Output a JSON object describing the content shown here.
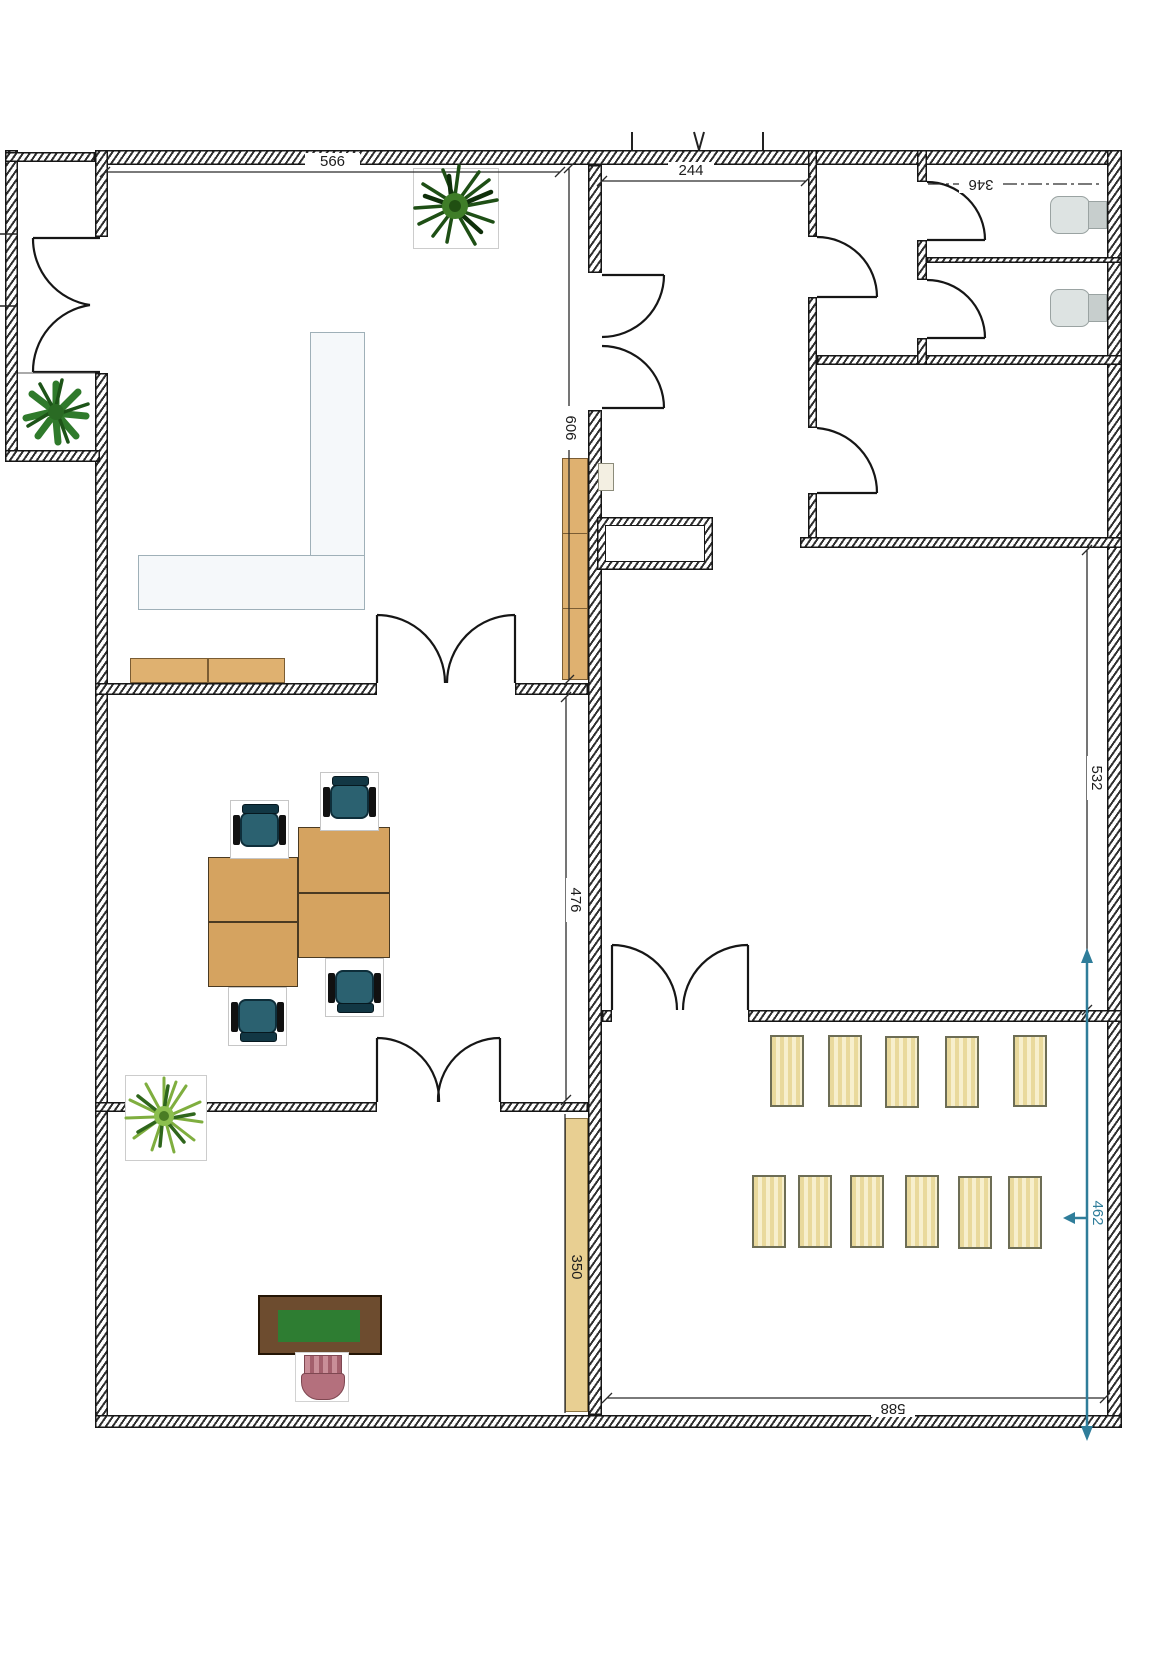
{
  "floorplan": {
    "dims": {
      "d566": "566",
      "d244": "244",
      "d346": "346",
      "d606": "606",
      "d476": "476",
      "d532": "532",
      "d350": "350",
      "d462": "462",
      "d588": "588"
    },
    "colors": {
      "wall_line": "#161616",
      "wood_desk": "#d5a360",
      "cabinet": "#dfb170",
      "cabinet_light": "#e8cf92",
      "mat": "#efe4b4",
      "chair_teal": "#2b6170",
      "dim_blue": "#2f7d9a",
      "desk_brown": "#6d4c2f",
      "blotter_green": "#2e7d32",
      "chair_pink": "#b4707d",
      "plant_green": "#2e7d32"
    }
  }
}
